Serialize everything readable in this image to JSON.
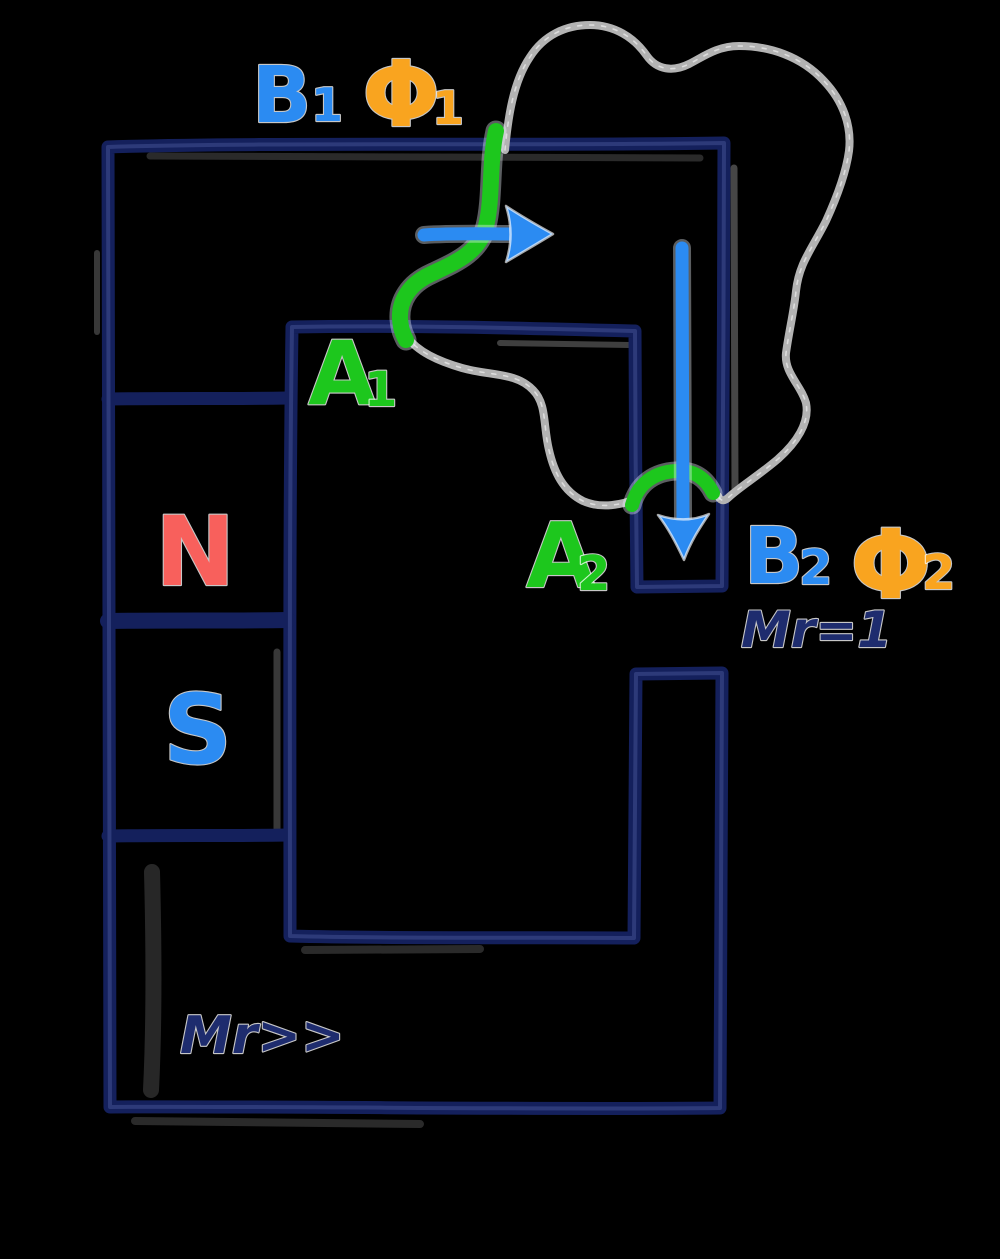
{
  "diagram": {
    "background": "#000000",
    "colors": {
      "core": "#14205c",
      "core_sheen": "#9fb0ff",
      "navy_text": "#1e2c6e",
      "green": "#1dc71d",
      "blue": "#2b8bf2",
      "orange": "#f9a41f",
      "red": "#f8605c",
      "gray": "#b3b3b3"
    },
    "labels": {
      "b1": {
        "base": "B",
        "sub": "1"
      },
      "phi1": {
        "base": "Φ",
        "sub": "1"
      },
      "a1": {
        "base": "A",
        "sub": "1"
      },
      "a2": {
        "base": "A",
        "sub": "2"
      },
      "b2": {
        "base": "B",
        "sub": "2"
      },
      "phi2": {
        "base": "Φ",
        "sub": "2"
      },
      "magnet_north": "N",
      "magnet_south": "S",
      "gap_permeability": "Mr=1",
      "core_permeability": "Mr>>"
    }
  }
}
